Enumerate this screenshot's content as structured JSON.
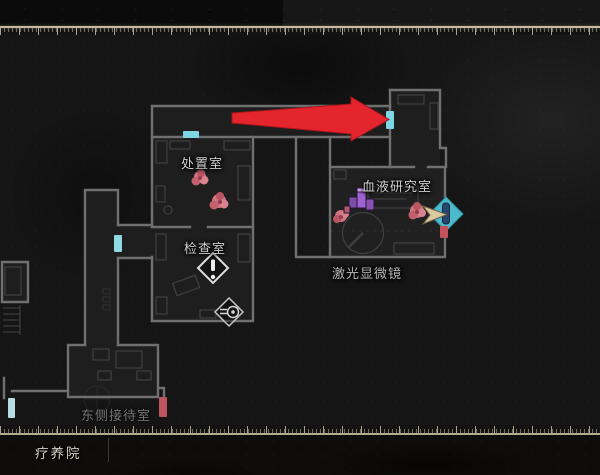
{
  "map": {
    "floor_label": "疗养院",
    "rooms": {
      "disposal": {
        "label": "处置室"
      },
      "examination": {
        "label": "检查室"
      },
      "blood_research": {
        "label": "血液研究室"
      },
      "laser_microscope": {
        "label": "激光显微镜"
      },
      "east_reception": {
        "label": "东侧接待室"
      }
    },
    "icons": {
      "guide_arrow": "red-arrow-pointing-right",
      "player": "player-direction-arrow",
      "exit_diamond": "door-exit-diamond",
      "alert": "exclamation-diamond",
      "projector": "projector-item-diamond",
      "enemy": "enemy-blob",
      "item": "purple-item-pickup",
      "door": "door-bar-marker"
    },
    "colors": {
      "guide_arrow": "#e4252d",
      "door_cyan": "#7ed7e4",
      "door_pale": "#b7dde4",
      "door_red": "#bf5560",
      "exit_diamond": "#4cb9cd",
      "player_arrow": "#dbc9a4",
      "item_purple": "#9f63cf",
      "enemy_pink": "#cf7480",
      "wall": "#707070",
      "room_fill": "#1e1e1e",
      "background": "#151515",
      "ruler": "#b5ac92",
      "label_text": "#cdcdcd"
    }
  }
}
